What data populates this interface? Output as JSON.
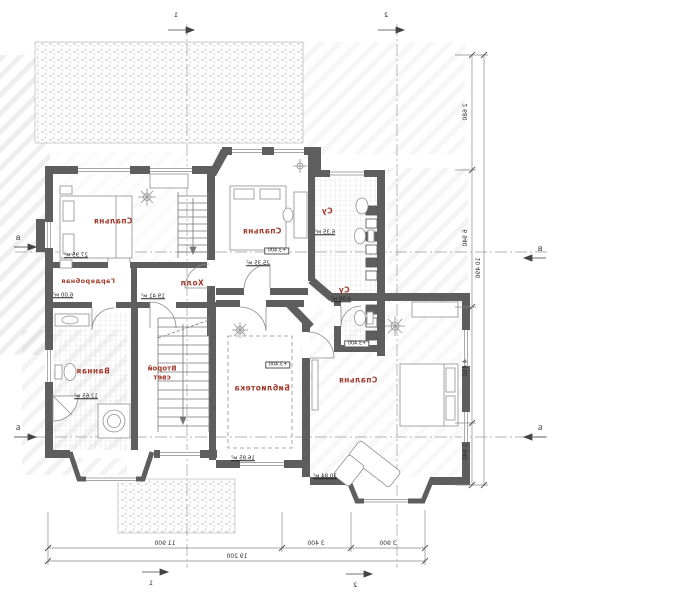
{
  "rooms": [
    {
      "id": "bedroom-1",
      "name": "Спальня",
      "area": "27.95 м²"
    },
    {
      "id": "wardrobe",
      "name": "Гардеробная",
      "area": "6.00 м²"
    },
    {
      "id": "bedroom-2",
      "name": "Спальня",
      "area": "25.35 м²",
      "level": "+3.400"
    },
    {
      "id": "bath-1",
      "name": "Су",
      "area": "6.35 м²"
    },
    {
      "id": "bath-2",
      "name": "Су",
      "area": "4.00 м²"
    },
    {
      "id": "hall",
      "name": "Холл",
      "area": "19.41 м²"
    },
    {
      "id": "bathroom",
      "name": "Ванная",
      "area": "12.65 м²"
    },
    {
      "id": "second-light",
      "name_line1": "Второй",
      "name_line2": "свет"
    },
    {
      "id": "library",
      "name": "Библиотека",
      "area": "16.85 м²",
      "level": "+3.400"
    },
    {
      "id": "bedroom-3",
      "name": "Спальня",
      "area": "30.84 м²",
      "level": "+3.400"
    }
  ],
  "dimensions": {
    "bottom_segments": [
      "11 900",
      "3 400",
      "3 900"
    ],
    "bottom_total": "19 200",
    "right_segments": [
      "2 680",
      "6 940",
      "4 450",
      "1 940"
    ],
    "right_total": "10 490"
  },
  "axes": {
    "top": [
      "1",
      "2"
    ],
    "bottom": [
      "1",
      "2"
    ],
    "left": [
      "В",
      "Б"
    ],
    "right": [
      "В",
      "Б"
    ]
  },
  "colors": {
    "wall": "#5e5e5e",
    "room_label": "#a03a2c",
    "dim_text": "#333333"
  }
}
